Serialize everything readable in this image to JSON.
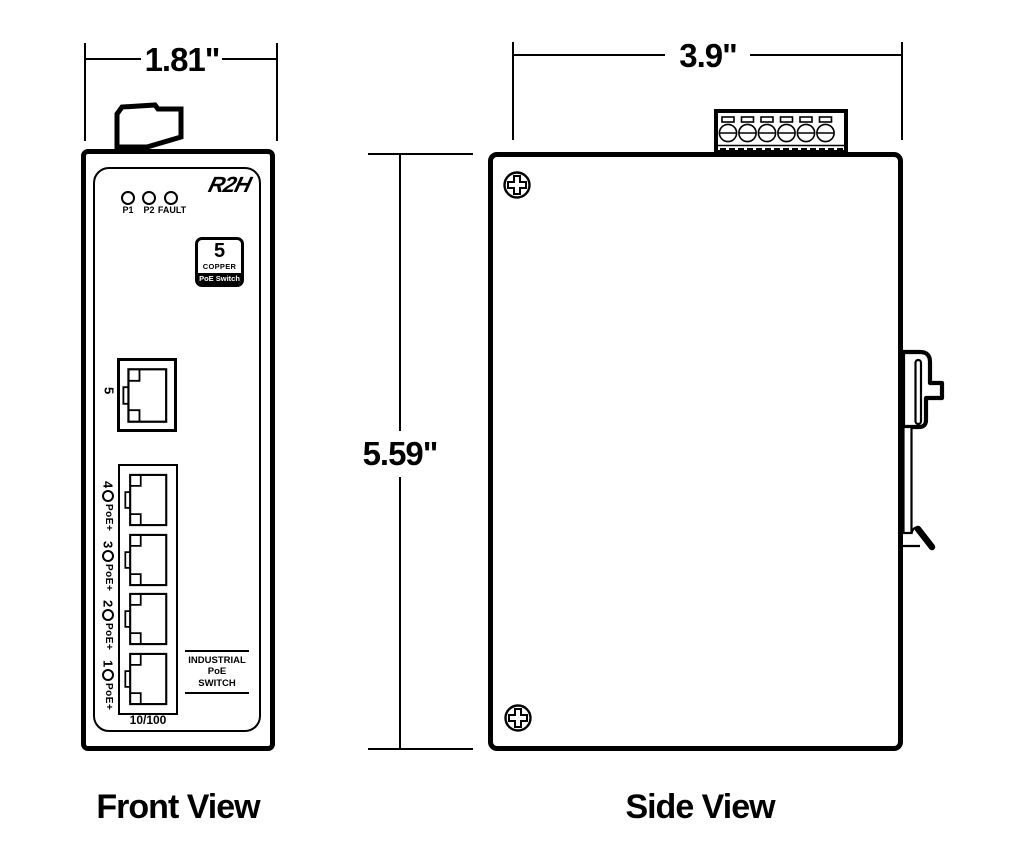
{
  "colors": {
    "ink": "#000000",
    "paper": "#ffffff"
  },
  "front_view": {
    "caption": "Front View",
    "width_dim": "1.81\"",
    "logo_text": "R2H",
    "leds": [
      {
        "label": "P1"
      },
      {
        "label": "P2"
      },
      {
        "label": "FAULT"
      }
    ],
    "badge": {
      "count": "5",
      "media": "COPPER",
      "product": "PoE Switch"
    },
    "uplink_port_number": "5",
    "ports": [
      {
        "number": "4",
        "poe_label": "PoE+"
      },
      {
        "number": "3",
        "poe_label": "PoE+"
      },
      {
        "number": "2",
        "poe_label": "PoE+"
      },
      {
        "number": "1",
        "poe_label": "PoE+"
      }
    ],
    "speed_label": "10/100",
    "panel_text": [
      "INDUSTRIAL",
      "PoE",
      "SWITCH"
    ]
  },
  "side_view": {
    "caption": "Side View",
    "width_dim": "3.9\"",
    "height_dim": "5.59\""
  }
}
